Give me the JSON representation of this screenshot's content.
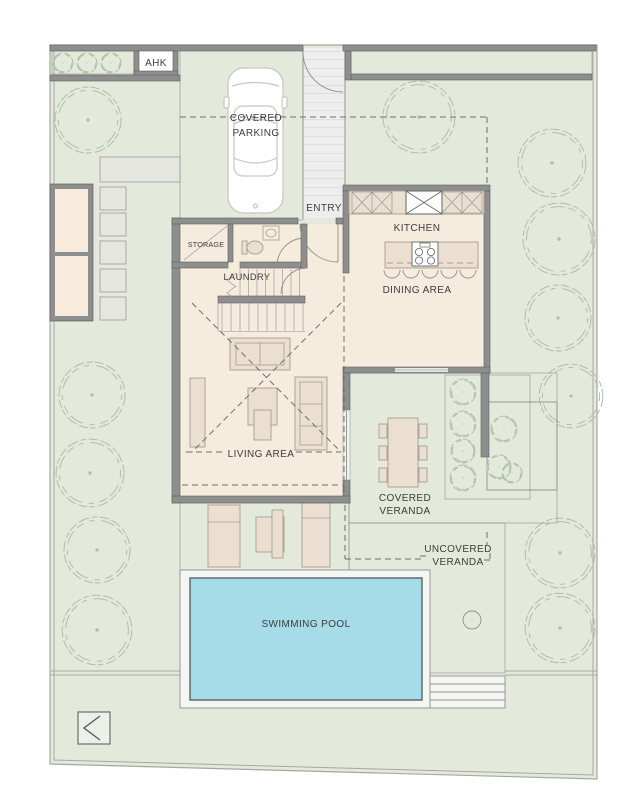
{
  "labels": {
    "ahk": "AHK",
    "covered_parking_line1": "COVERED",
    "covered_parking_line2": "PARKING",
    "entry": "ENTRY",
    "storage": "STORAGE",
    "laundry": "LAUNDRY",
    "kitchen": "KITCHEN",
    "dining_area": "DINING AREA",
    "living_area": "LIVING AREA",
    "covered_veranda_line1": "COVERED",
    "covered_veranda_line2": "VERANDA",
    "uncovered_veranda_line1": "UNCOVERED",
    "uncovered_veranda_line2": "VERANDA",
    "swimming_pool": "SWIMMING POOL"
  },
  "colors": {
    "lawn": "#e3eadb",
    "planter": "#dfe8d6",
    "boundary": "#a7a8a0",
    "wall": "#8e8e8e",
    "wall_edge": "#5e5e5e",
    "floor": "#f6ecde",
    "furniture": "#eadfd0",
    "furniture_edge": "#a79d8e",
    "brick_bg": "#e9e9e6",
    "brick_line": "#cdcdc9",
    "tile_bg": "#ededea",
    "tile_line": "#d9d9d4",
    "tile2_bg": "#f3f3ef",
    "tile2_line": "#e2e2db",
    "stripe_bg": "#ecedec",
    "stripe_line": "#cbcbc8",
    "deck": "#f5f5f2",
    "pool": "#a6dce8",
    "pool_edge": "#51656b",
    "tree": "#aebfa8",
    "line": "#8f8f8f",
    "dashline": "#6e6e6e",
    "text": "#3c3c3c",
    "car": "#c6c6c3",
    "stone": "#e6e6e1",
    "north_bg": "#edf0e8",
    "window": "#e9e9e9"
  }
}
